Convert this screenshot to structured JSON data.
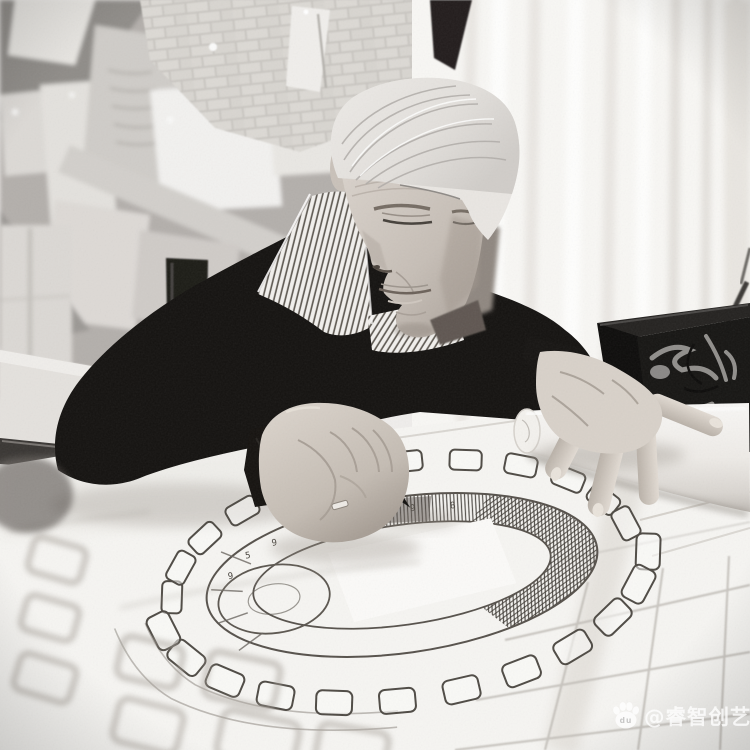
{
  "meta": {
    "kind": "black-and-white photograph",
    "subject": "elderly designer leaning over a drafting table sketching a stadium arena floor plan with a black marker"
  },
  "palette": {
    "wall": "#b3afab",
    "brick": "#cfccc7",
    "curtain": "#f8f7f4",
    "sweater": "#141210",
    "hair": "#e9e6e2",
    "skin_face": "#c9c1b9",
    "skin_hand": "#d8d1c9",
    "paper": "#f6f5f2",
    "roll": "#f3f1ed",
    "box": "#161513",
    "ink": "#56514b",
    "grid": "#bdb9b3"
  },
  "plan": {
    "type": "stadium-arena-floor-plan-sketch",
    "numbers": [
      "9",
      "5",
      "9",
      "2",
      "9",
      "6",
      "9",
      "8",
      "6",
      "9"
    ]
  },
  "watermark": {
    "handle": "@睿智创艺",
    "logo_name": "baidu-paw-logo",
    "logo_text": "du",
    "color": "#ffffff"
  }
}
